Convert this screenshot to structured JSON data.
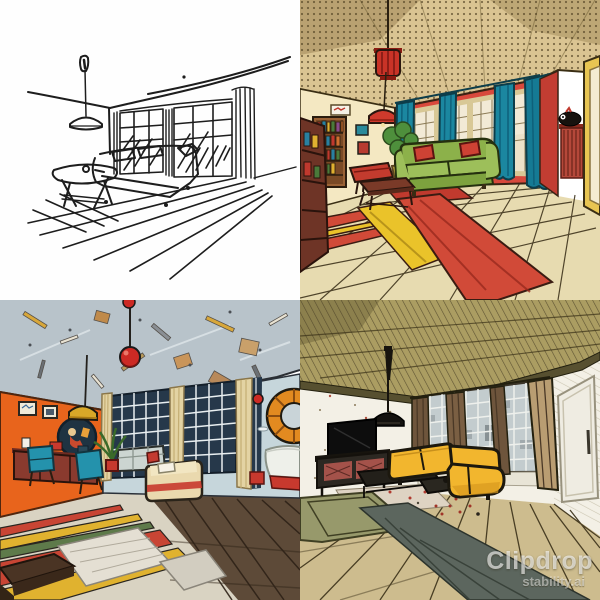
{
  "watermark": {
    "line1": "Clipdrop",
    "line2": "stability.ai"
  },
  "grid": {
    "layout": "2x2",
    "panels": [
      {
        "id": "top-left",
        "style": "black-and-white ink sketch",
        "description": "Ink sketch of a living room with a pendant lamp, sofa, oval coffee table, tall curtained windows and diagonal floor lines"
      },
      {
        "id": "top-right",
        "style": "retro comic, warm palette",
        "description": "Comic living room with halftone beige ceiling, red lantern lamp, red walls, teal curtains, green sofa with red pillows, bookshelf and red-and-yellow striped rug on parquet"
      },
      {
        "id": "bottom-left",
        "style": "pop-art, orange and blue",
        "description": "Pop-art living room with gray-blue confetti ceiling, red ball pendant, orange wall with frames, dark-framed windows, teal chairs, cream sofa, striped rug and round orange porthole mirror"
      },
      {
        "id": "bottom-right",
        "style": "muted hatched comic",
        "description": "Hatched living room with olive ceiling, black cone pendant, wall TV and media console, yellow sectional sofa, brown curtains, white door and streaked wood floor"
      }
    ]
  },
  "palette": {
    "sketch_ink": "#1d1d1d",
    "comic_red_wall": "#d8493c",
    "teal_curtain": "#1b87a0",
    "green_sofa": "#8cb14a",
    "rug_red": "#d14a38",
    "rug_yellow": "#eac32a",
    "orange_wall": "#e8641c",
    "ceiling_blue_gray": "#b8c3ca",
    "pendant_red": "#cc2a24",
    "porthole_orange": "#e28a20",
    "olive_ceiling": "#ab9d62",
    "yellow_sofa": "#f2b62e",
    "wood_floor_tan": "#cdbc8e",
    "wood_floor_dark": "#5d4a38"
  }
}
